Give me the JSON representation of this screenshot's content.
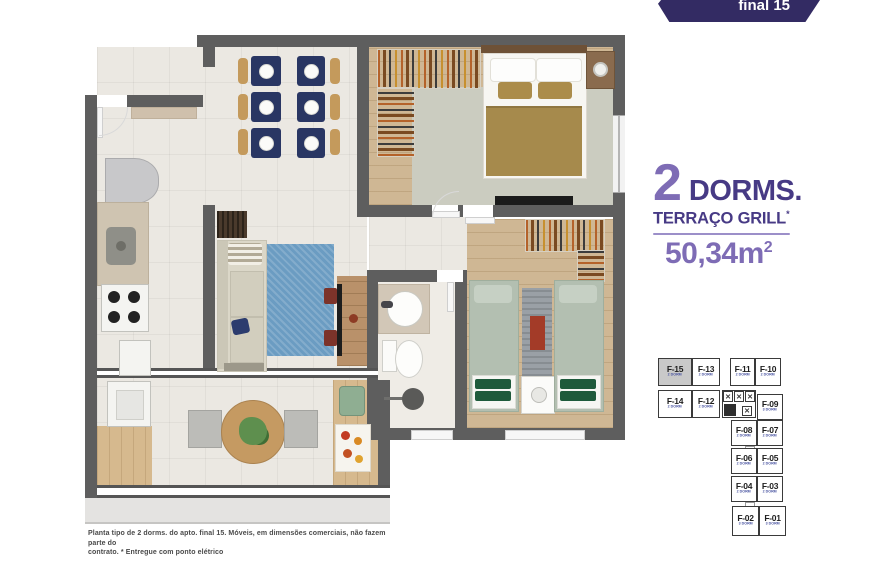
{
  "banner": {
    "label": "final 15",
    "bg": "#332b63"
  },
  "info": {
    "dorms_number": "2",
    "dorms_word": "DORMS.",
    "feature": "TERRAÇO GRILL",
    "feature_mark": "*",
    "area": "50,34m",
    "area_sup": "2",
    "accent_light": "#7e6cb5",
    "accent_dark": "#473a85",
    "divider_color": "#9c8fc9"
  },
  "keyplan": {
    "elevator_mark": "✕",
    "units": [
      {
        "label": "F-15",
        "sub": "2 DORM",
        "highlighted": true
      },
      {
        "label": "F-13",
        "sub": "2 DORM"
      },
      {
        "label": "F-11",
        "sub": "2 DORM"
      },
      {
        "label": "F-10",
        "sub": "2 DORM"
      },
      {
        "label": "F-14",
        "sub": "2 DORM"
      },
      {
        "label": "F-12",
        "sub": "2 DORM"
      },
      {
        "label": "F-09",
        "sub": "3 DORM"
      },
      {
        "label": "F-08",
        "sub": "2 DORM"
      },
      {
        "label": "F-07",
        "sub": "2 DORM"
      },
      {
        "label": "F-06",
        "sub": "2 DORM"
      },
      {
        "label": "F-05",
        "sub": "2 DORM"
      },
      {
        "label": "F-04",
        "sub": "2 DORM"
      },
      {
        "label": "F-03",
        "sub": "2 DORM"
      },
      {
        "label": "F-02",
        "sub": "3 DORM"
      },
      {
        "label": "F-01",
        "sub": "3 DORM"
      }
    ]
  },
  "disclaimer": {
    "line1": "Planta tipo de 2 dorms. do apto. final 15. Móveis, em dimensões comerciais, não fazem parte do",
    "line2": "contrato. * Entregue com ponto elétrico"
  }
}
